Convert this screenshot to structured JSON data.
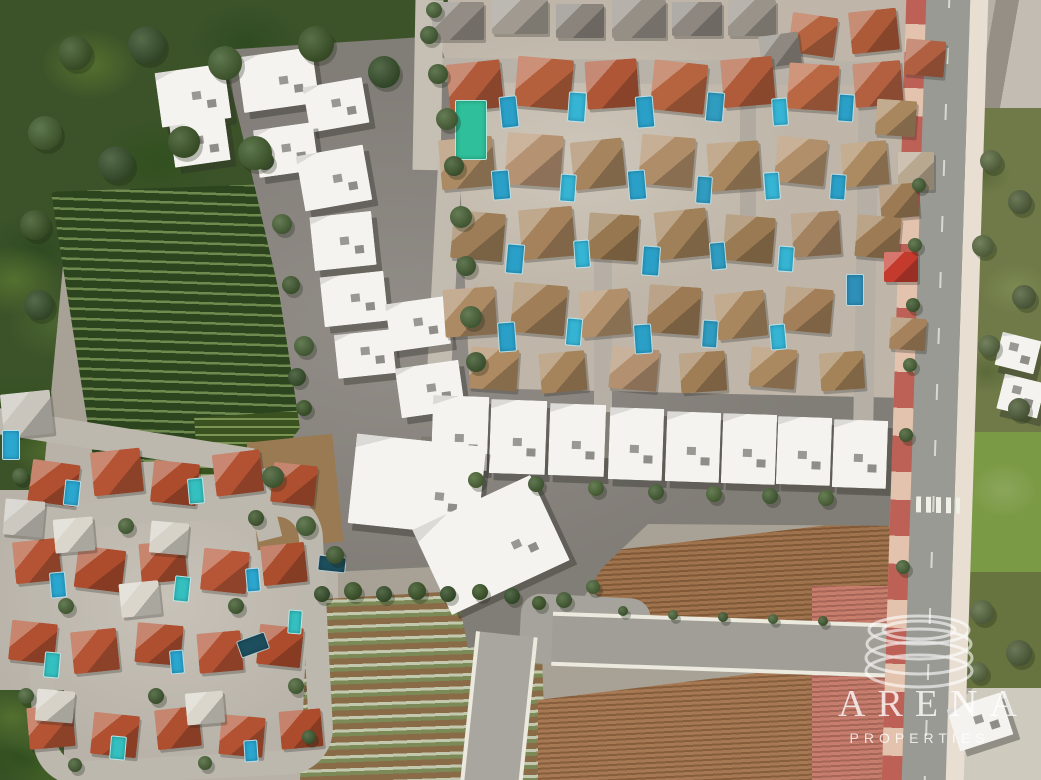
{
  "watermark": {
    "brand": "ARENA",
    "tagline": "PROPERTIES",
    "logo": "stacked-discs-icon",
    "color": "#ffffff"
  },
  "palette": {
    "woodland_green": "#3c5329",
    "vineyard_dark": "#2c451f",
    "vineyard_light": "#70894e",
    "construction_dirt": "#8b8680",
    "bare_dirt_tan": "#9a7a52",
    "villa_block_base": "#c9c0b2",
    "village_base": "#c3bdb2",
    "asphalt": "#9a9a94",
    "sidewalk_pink": "#e3c3ae",
    "bike_lane_red": "#b04038",
    "plowed_field_brown": "#996a42",
    "crop_row_light": "#c2c9ae",
    "crop_row_green": "#7c8a58",
    "pool_blue": "#2aa0c8",
    "pool_green": "#2fbf9a",
    "roof_terracotta": "#b15a3a",
    "roof_tan": "#ab8a64",
    "roof_orange": "#b05030",
    "new_build_white": "#f4f3ef",
    "grass_green": "#7b9a45",
    "scrub_olive": "#6f7a48",
    "tinted_dirt_pink": "#c97868"
  },
  "scene": {
    "white_buildings": [
      [
        158,
        68,
        70,
        55,
        -8
      ],
      [
        240,
        52,
        76,
        56,
        -8
      ],
      [
        306,
        82,
        60,
        46,
        -10
      ],
      [
        172,
        122,
        56,
        42,
        -8
      ],
      [
        256,
        126,
        60,
        48,
        -8
      ],
      [
        300,
        150,
        68,
        56,
        -10
      ],
      [
        312,
        214,
        62,
        54,
        -6
      ],
      [
        322,
        274,
        64,
        50,
        -6
      ],
      [
        336,
        332,
        58,
        44,
        -6
      ],
      [
        388,
        300,
        60,
        48,
        -8
      ],
      [
        398,
        364,
        64,
        50,
        -8
      ],
      [
        432,
        396,
        56,
        74,
        2
      ],
      [
        490,
        400,
        56,
        74,
        2
      ],
      [
        549,
        404,
        56,
        72,
        2
      ],
      [
        609,
        408,
        54,
        72,
        2
      ],
      [
        666,
        412,
        54,
        70,
        2
      ],
      [
        722,
        414,
        54,
        70,
        2
      ],
      [
        777,
        417,
        54,
        68,
        2
      ],
      [
        833,
        420,
        54,
        68,
        2
      ],
      [
        352,
        440,
        130,
        90,
        6
      ],
      [
        426,
        498,
        130,
        94,
        -25
      ],
      [
        998,
        336,
        40,
        34,
        14
      ],
      [
        1000,
        378,
        42,
        36,
        14
      ],
      [
        952,
        700,
        56,
        44,
        -18
      ]
    ],
    "villas": [
      [
        432,
        2,
        52,
        38,
        0,
        "#928c84"
      ],
      [
        492,
        0,
        56,
        34,
        0,
        "#a09a90"
      ],
      [
        556,
        4,
        48,
        34,
        0,
        "#8a847c"
      ],
      [
        612,
        0,
        54,
        38,
        0,
        "#968f86"
      ],
      [
        672,
        2,
        50,
        34,
        0,
        "#8d8780"
      ],
      [
        728,
        0,
        48,
        36,
        0,
        "#9a9389"
      ],
      [
        790,
        15,
        46,
        40,
        8,
        "#b5643f"
      ],
      [
        850,
        10,
        48,
        42,
        -6,
        "#ad5a38"
      ],
      [
        905,
        40,
        40,
        36,
        5,
        "#b06040"
      ],
      [
        760,
        34,
        40,
        32,
        -8,
        "#8e8880"
      ],
      [
        448,
        62,
        54,
        48,
        -6,
        "#b15a3a"
      ],
      [
        516,
        58,
        56,
        50,
        5,
        "#b5603c"
      ],
      [
        586,
        60,
        52,
        48,
        -4,
        "#ae5636"
      ],
      [
        652,
        62,
        54,
        50,
        6,
        "#b5643f"
      ],
      [
        722,
        58,
        52,
        48,
        -5,
        "#b05c3a"
      ],
      [
        788,
        64,
        50,
        46,
        4,
        "#ba6844"
      ],
      [
        854,
        62,
        48,
        44,
        -5,
        "#b26040"
      ],
      [
        876,
        100,
        40,
        36,
        4,
        "#a8875f"
      ],
      [
        440,
        138,
        54,
        50,
        -5,
        "#ab8a64"
      ],
      [
        506,
        134,
        56,
        52,
        4,
        "#b59272"
      ],
      [
        572,
        140,
        52,
        48,
        -6,
        "#a5845e"
      ],
      [
        640,
        136,
        54,
        50,
        5,
        "#af8d68"
      ],
      [
        708,
        142,
        52,
        48,
        -4,
        "#a8875f"
      ],
      [
        776,
        138,
        50,
        46,
        6,
        "#b08f6a"
      ],
      [
        842,
        142,
        46,
        44,
        -5,
        "#ac8a62"
      ],
      [
        898,
        152,
        36,
        38,
        0,
        "#b8a890"
      ],
      [
        880,
        184,
        38,
        34,
        -5,
        "#9c7b54"
      ],
      [
        452,
        212,
        52,
        48,
        5,
        "#9c7d57"
      ],
      [
        520,
        208,
        54,
        50,
        -5,
        "#a5825c"
      ],
      [
        588,
        214,
        50,
        46,
        4,
        "#97774f"
      ],
      [
        656,
        210,
        52,
        48,
        -6,
        "#a08058"
      ],
      [
        724,
        216,
        50,
        46,
        5,
        "#9a7a52"
      ],
      [
        792,
        212,
        48,
        44,
        -4,
        "#a38260"
      ],
      [
        856,
        216,
        44,
        42,
        5,
        "#9d7c55"
      ],
      [
        884,
        252,
        34,
        30,
        0,
        "#c43b2e"
      ],
      [
        444,
        288,
        52,
        48,
        -4,
        "#ab8a64"
      ],
      [
        512,
        284,
        54,
        50,
        5,
        "#a07f58"
      ],
      [
        580,
        290,
        50,
        46,
        -5,
        "#b08f6a"
      ],
      [
        648,
        286,
        52,
        48,
        4,
        "#9c7b54"
      ],
      [
        716,
        292,
        50,
        46,
        -6,
        "#a8875f"
      ],
      [
        784,
        288,
        48,
        44,
        5,
        "#a27f58"
      ],
      [
        890,
        318,
        36,
        32,
        4,
        "#a5825c"
      ],
      [
        470,
        348,
        48,
        42,
        4,
        "#ad8a62"
      ],
      [
        540,
        352,
        46,
        40,
        -5,
        "#a5845c"
      ],
      [
        610,
        348,
        48,
        42,
        5,
        "#b29070"
      ],
      [
        680,
        352,
        46,
        40,
        -4,
        "#9f7e56"
      ],
      [
        750,
        348,
        46,
        40,
        5,
        "#aa8960"
      ],
      [
        820,
        352,
        44,
        38,
        -4,
        "#a48358"
      ],
      [
        30,
        462,
        48,
        42,
        8,
        "#b05030"
      ],
      [
        92,
        450,
        50,
        44,
        -6,
        "#b45434"
      ],
      [
        152,
        462,
        46,
        42,
        6,
        "#ac4c2c"
      ],
      [
        214,
        452,
        48,
        42,
        -7,
        "#b25232"
      ],
      [
        272,
        464,
        44,
        40,
        6,
        "#ae5030"
      ],
      [
        14,
        540,
        46,
        42,
        -6,
        "#b45434"
      ],
      [
        76,
        548,
        48,
        42,
        7,
        "#ac4c2c"
      ],
      [
        140,
        542,
        46,
        40,
        -5,
        "#b05030"
      ],
      [
        202,
        550,
        46,
        42,
        6,
        "#b65636"
      ],
      [
        262,
        544,
        44,
        40,
        -6,
        "#aa4e2e"
      ],
      [
        10,
        622,
        46,
        40,
        6,
        "#b05030"
      ],
      [
        72,
        630,
        46,
        42,
        -6,
        "#b45434"
      ],
      [
        136,
        624,
        46,
        40,
        5,
        "#ae5030"
      ],
      [
        198,
        632,
        44,
        40,
        -5,
        "#b25232"
      ],
      [
        258,
        626,
        44,
        40,
        6,
        "#ac4c2c"
      ],
      [
        28,
        706,
        46,
        42,
        -5,
        "#b45434"
      ],
      [
        92,
        714,
        46,
        42,
        6,
        "#b05030"
      ],
      [
        156,
        708,
        44,
        40,
        -6,
        "#ae5030"
      ],
      [
        220,
        716,
        44,
        40,
        5,
        "#b25232"
      ],
      [
        280,
        710,
        42,
        38,
        -5,
        "#ac4c2c"
      ],
      [
        54,
        518,
        40,
        34,
        -5,
        "#dad6cc"
      ],
      [
        150,
        522,
        38,
        32,
        5,
        "#d6d2c8"
      ],
      [
        120,
        582,
        40,
        34,
        -6,
        "#dad6cc"
      ],
      [
        36,
        690,
        38,
        32,
        5,
        "#d6d2c8"
      ],
      [
        186,
        692,
        38,
        32,
        -5,
        "#dad6cc"
      ],
      [
        2,
        392,
        50,
        44,
        -6,
        "#c9c5bc"
      ],
      [
        4,
        500,
        40,
        36,
        5,
        "#ccc8c0"
      ]
    ],
    "pools": [
      [
        500,
        96,
        16,
        30,
        -6,
        "#2aa0c8"
      ],
      [
        568,
        92,
        16,
        28,
        4,
        "#35b4d4"
      ],
      [
        636,
        96,
        16,
        30,
        -5,
        "#2aa0c8"
      ],
      [
        706,
        92,
        16,
        28,
        5,
        "#2f9cc0"
      ],
      [
        772,
        98,
        14,
        26,
        -4,
        "#35b4d4"
      ],
      [
        838,
        94,
        14,
        26,
        4,
        "#2aa0c8"
      ],
      [
        455,
        100,
        30,
        58,
        0,
        "#2fbf9a"
      ],
      [
        492,
        170,
        16,
        28,
        -5,
        "#2aa0c8"
      ],
      [
        560,
        174,
        14,
        26,
        4,
        "#35b4d4"
      ],
      [
        628,
        170,
        16,
        28,
        -5,
        "#2aa0c8"
      ],
      [
        696,
        176,
        14,
        26,
        4,
        "#2f9cc0"
      ],
      [
        764,
        172,
        14,
        26,
        -4,
        "#35b4d4"
      ],
      [
        830,
        174,
        14,
        24,
        4,
        "#2aa0c8"
      ],
      [
        506,
        244,
        16,
        28,
        5,
        "#2aa0c8"
      ],
      [
        574,
        240,
        14,
        26,
        -4,
        "#35b4d4"
      ],
      [
        642,
        246,
        16,
        28,
        4,
        "#2aa0c8"
      ],
      [
        710,
        242,
        14,
        26,
        -5,
        "#2f9cc0"
      ],
      [
        778,
        246,
        14,
        24,
        4,
        "#35b4d4"
      ],
      [
        498,
        322,
        16,
        28,
        -4,
        "#2aa0c8"
      ],
      [
        566,
        318,
        14,
        26,
        5,
        "#35b4d4"
      ],
      [
        634,
        324,
        16,
        28,
        -4,
        "#2aa0c8"
      ],
      [
        702,
        320,
        14,
        26,
        4,
        "#2f9cc0"
      ],
      [
        770,
        324,
        14,
        24,
        -5,
        "#35b4d4"
      ],
      [
        846,
        274,
        16,
        30,
        0,
        "#2e8fb8"
      ],
      [
        64,
        480,
        14,
        24,
        6,
        "#2aa6cf"
      ],
      [
        188,
        478,
        14,
        24,
        -5,
        "#35c0c0"
      ],
      [
        50,
        572,
        14,
        24,
        -5,
        "#2aa6cf"
      ],
      [
        174,
        576,
        14,
        24,
        6,
        "#35c0c0"
      ],
      [
        246,
        568,
        12,
        22,
        -5,
        "#2aa6cf"
      ],
      [
        44,
        652,
        14,
        24,
        5,
        "#35c0c0"
      ],
      [
        170,
        650,
        12,
        22,
        -5,
        "#2aa6cf"
      ],
      [
        110,
        736,
        14,
        22,
        5,
        "#35c0c0"
      ],
      [
        244,
        740,
        12,
        20,
        -4,
        "#2aa6cf"
      ],
      [
        2,
        430,
        16,
        28,
        0,
        "#2aa6cf"
      ],
      [
        288,
        610,
        12,
        22,
        4,
        "#35c0c0"
      ],
      [
        238,
        636,
        28,
        16,
        -20,
        "#1d4e5e"
      ],
      [
        318,
        556,
        26,
        14,
        6,
        "#1d4e5e"
      ]
    ],
    "trees": [
      [
        428,
        64,
        20,
        "#3f5a2c"
      ],
      [
        436,
        108,
        22,
        "#446030"
      ],
      [
        444,
        156,
        20,
        "#3a5528"
      ],
      [
        450,
        206,
        22,
        "#446030"
      ],
      [
        456,
        256,
        20,
        "#3f5a2c"
      ],
      [
        460,
        306,
        22,
        "#446030"
      ],
      [
        466,
        352,
        20,
        "#3a5528"
      ],
      [
        256,
        152,
        18,
        "#3f5a2c"
      ],
      [
        272,
        214,
        20,
        "#446030"
      ],
      [
        282,
        276,
        18,
        "#3a5528"
      ],
      [
        294,
        336,
        20,
        "#446030"
      ],
      [
        262,
        466,
        22,
        "#3f5a2c"
      ],
      [
        296,
        516,
        20,
        "#446030"
      ],
      [
        326,
        546,
        18,
        "#3a5528"
      ],
      [
        288,
        368,
        18,
        "#2f4a22"
      ],
      [
        296,
        400,
        16,
        "#35511f"
      ],
      [
        314,
        586,
        16,
        "#2f4a22"
      ],
      [
        344,
        582,
        18,
        "#35511f"
      ],
      [
        376,
        586,
        16,
        "#2f4a22"
      ],
      [
        408,
        582,
        18,
        "#35511f"
      ],
      [
        440,
        586,
        16,
        "#2f4a22"
      ],
      [
        472,
        584,
        16,
        "#35511f"
      ],
      [
        504,
        588,
        16,
        "#2f4a22"
      ],
      [
        532,
        596,
        14,
        "#35511f"
      ],
      [
        556,
        592,
        16,
        "#3f5a2c"
      ],
      [
        586,
        580,
        14,
        "#446030"
      ],
      [
        618,
        606,
        10,
        "#3a5528"
      ],
      [
        668,
        610,
        10,
        "#446030"
      ],
      [
        718,
        612,
        10,
        "#3a5528"
      ],
      [
        768,
        614,
        10,
        "#446030"
      ],
      [
        818,
        616,
        10,
        "#3a5528"
      ],
      [
        468,
        472,
        16,
        "#47632f"
      ],
      [
        528,
        476,
        16,
        "#3f5a2c"
      ],
      [
        588,
        480,
        16,
        "#47632f"
      ],
      [
        648,
        484,
        16,
        "#3f5a2c"
      ],
      [
        706,
        486,
        16,
        "#47632f"
      ],
      [
        762,
        488,
        16,
        "#3f5a2c"
      ],
      [
        818,
        490,
        16,
        "#47632f"
      ],
      [
        912,
        178,
        14,
        "#3f5a2c"
      ],
      [
        908,
        238,
        14,
        "#446030"
      ],
      [
        906,
        298,
        14,
        "#3a5528"
      ],
      [
        903,
        358,
        14,
        "#446030"
      ],
      [
        899,
        428,
        14,
        "#3f5a2c"
      ],
      [
        896,
        560,
        14,
        "#446030"
      ],
      [
        980,
        150,
        22,
        "#55663a"
      ],
      [
        1008,
        190,
        24,
        "#4c5c34"
      ],
      [
        972,
        235,
        22,
        "#55663a"
      ],
      [
        1012,
        285,
        24,
        "#4c5c34"
      ],
      [
        978,
        335,
        22,
        "#55663a"
      ],
      [
        1008,
        398,
        22,
        "#4c5c34"
      ],
      [
        12,
        468,
        16,
        "#3f5a2c"
      ],
      [
        118,
        518,
        16,
        "#446030"
      ],
      [
        248,
        510,
        16,
        "#3a5528"
      ],
      [
        58,
        598,
        16,
        "#446030"
      ],
      [
        228,
        598,
        16,
        "#3f5a2c"
      ],
      [
        18,
        688,
        16,
        "#446030"
      ],
      [
        148,
        688,
        16,
        "#3a5528"
      ],
      [
        288,
        678,
        16,
        "#446030"
      ],
      [
        68,
        758,
        14,
        "#3f5a2c"
      ],
      [
        198,
        756,
        14,
        "#446030"
      ],
      [
        302,
        730,
        14,
        "#3a5528"
      ],
      [
        58,
        36,
        34,
        "#35511f"
      ],
      [
        128,
        26,
        38,
        "#2f4a22"
      ],
      [
        208,
        46,
        34,
        "#3c5a26"
      ],
      [
        298,
        26,
        36,
        "#35511f"
      ],
      [
        368,
        56,
        32,
        "#2f4a22"
      ],
      [
        28,
        116,
        34,
        "#3c5a26"
      ],
      [
        98,
        146,
        36,
        "#2f4a22"
      ],
      [
        168,
        126,
        32,
        "#35511f"
      ],
      [
        238,
        136,
        34,
        "#3c5a26"
      ],
      [
        20,
        210,
        30,
        "#35511f"
      ],
      [
        24,
        290,
        30,
        "#2f4a22"
      ],
      [
        420,
        26,
        18,
        "#3f5a2c"
      ],
      [
        426,
        2,
        16,
        "#446030"
      ],
      [
        970,
        600,
        24,
        "#55663a"
      ],
      [
        1006,
        640,
        26,
        "#4c5c34"
      ],
      [
        968,
        662,
        20,
        "#55663a"
      ]
    ]
  }
}
